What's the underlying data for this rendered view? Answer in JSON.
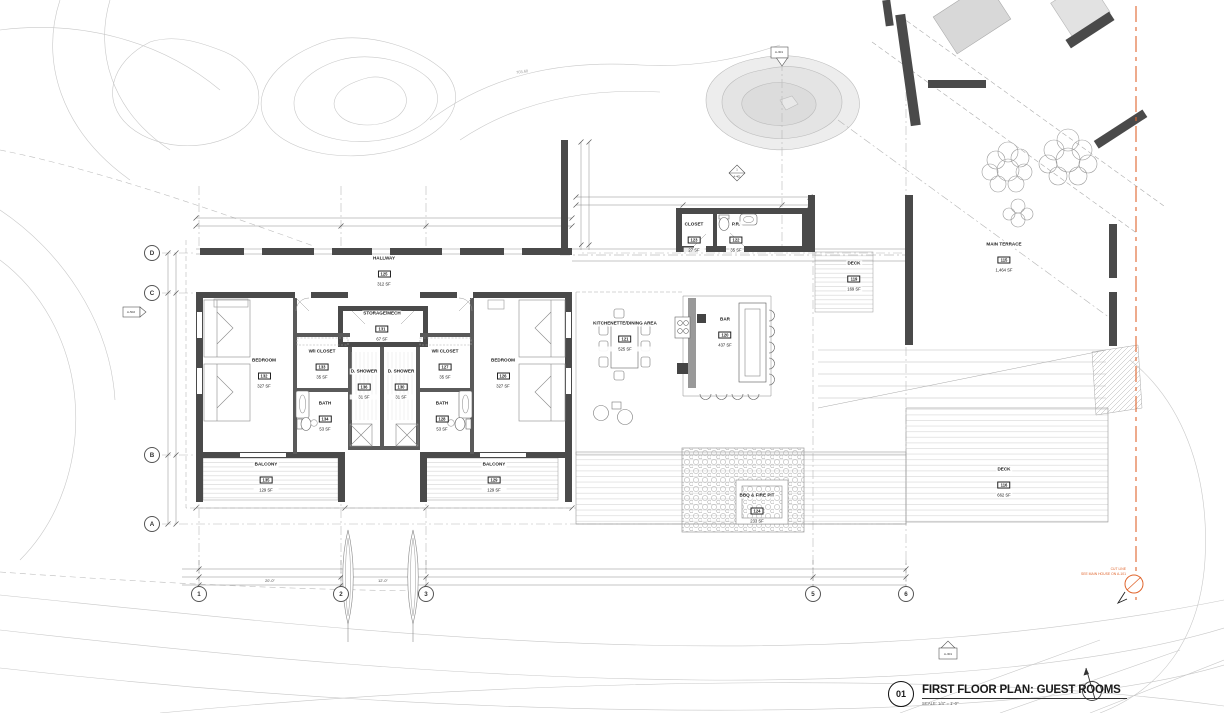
{
  "drawing": {
    "title_number": "01",
    "title": "FIRST FLOOR PLAN: GUEST ROOMS",
    "scale_note": "SCALE: 1/4\" = 1'-0\"",
    "contour_elevation": "703.60"
  },
  "cut_line": {
    "label": "CUT LINE",
    "note": "SEE MAIN HOUSE ON A-101"
  },
  "grid": {
    "columns": [
      "1",
      "2",
      "3",
      "5",
      "6"
    ],
    "rows": [
      "D",
      "C",
      "B",
      "A"
    ]
  },
  "dimensions": {
    "bay_1_2": "20'-0\"",
    "bay_2_3": "12'-0\""
  },
  "markers": {
    "left_section": "A-502",
    "pond_section": "A-301",
    "detail_diamond_top": "1",
    "detail_diamond_bottom": "A-401",
    "bottom_section": "A-301"
  },
  "rooms": [
    {
      "name": "HALLWAY",
      "number": "125",
      "area": "312 SF"
    },
    {
      "name": "STORAGE/MECH",
      "number": "131",
      "area": "67 SF"
    },
    {
      "name": "D. SHOWER",
      "number": "136",
      "area": "31 SF"
    },
    {
      "name": "D. SHOWER",
      "number": "130",
      "area": "31 SF"
    },
    {
      "name": "W/I CLOSET",
      "number": "133",
      "area": "35 SF"
    },
    {
      "name": "W/I CLOSET",
      "number": "127",
      "area": "35 SF"
    },
    {
      "name": "BEDROOM",
      "number": "132",
      "area": "327 SF"
    },
    {
      "name": "BEDROOM",
      "number": "126",
      "area": "327 SF"
    },
    {
      "name": "BATH",
      "number": "134",
      "area": "53 SF"
    },
    {
      "name": "BATH",
      "number": "128",
      "area": "53 SF"
    },
    {
      "name": "BALCONY",
      "number": "135",
      "area": "129 SF"
    },
    {
      "name": "BALCONY",
      "number": "129",
      "area": "129 SF"
    },
    {
      "name": "CLOSET",
      "number": "123",
      "area": "27 SF"
    },
    {
      "name": "P.R.",
      "number": "122",
      "area": "35 SF"
    },
    {
      "name": "KITCHENETTE/DINING AREA",
      "number": "121",
      "area": "525 SF"
    },
    {
      "name": "BAR",
      "number": "120",
      "area": "437 SF"
    },
    {
      "name": "DECK",
      "number": "119",
      "area": "169 SF"
    },
    {
      "name": "MAIN TERRACE",
      "number": "115",
      "area": "1,464 SF"
    },
    {
      "name": "DECK",
      "number": "116",
      "area": "662 SF"
    },
    {
      "name": "BBQ & FIRE PIT",
      "number": "124",
      "area": "233 SF"
    }
  ]
}
